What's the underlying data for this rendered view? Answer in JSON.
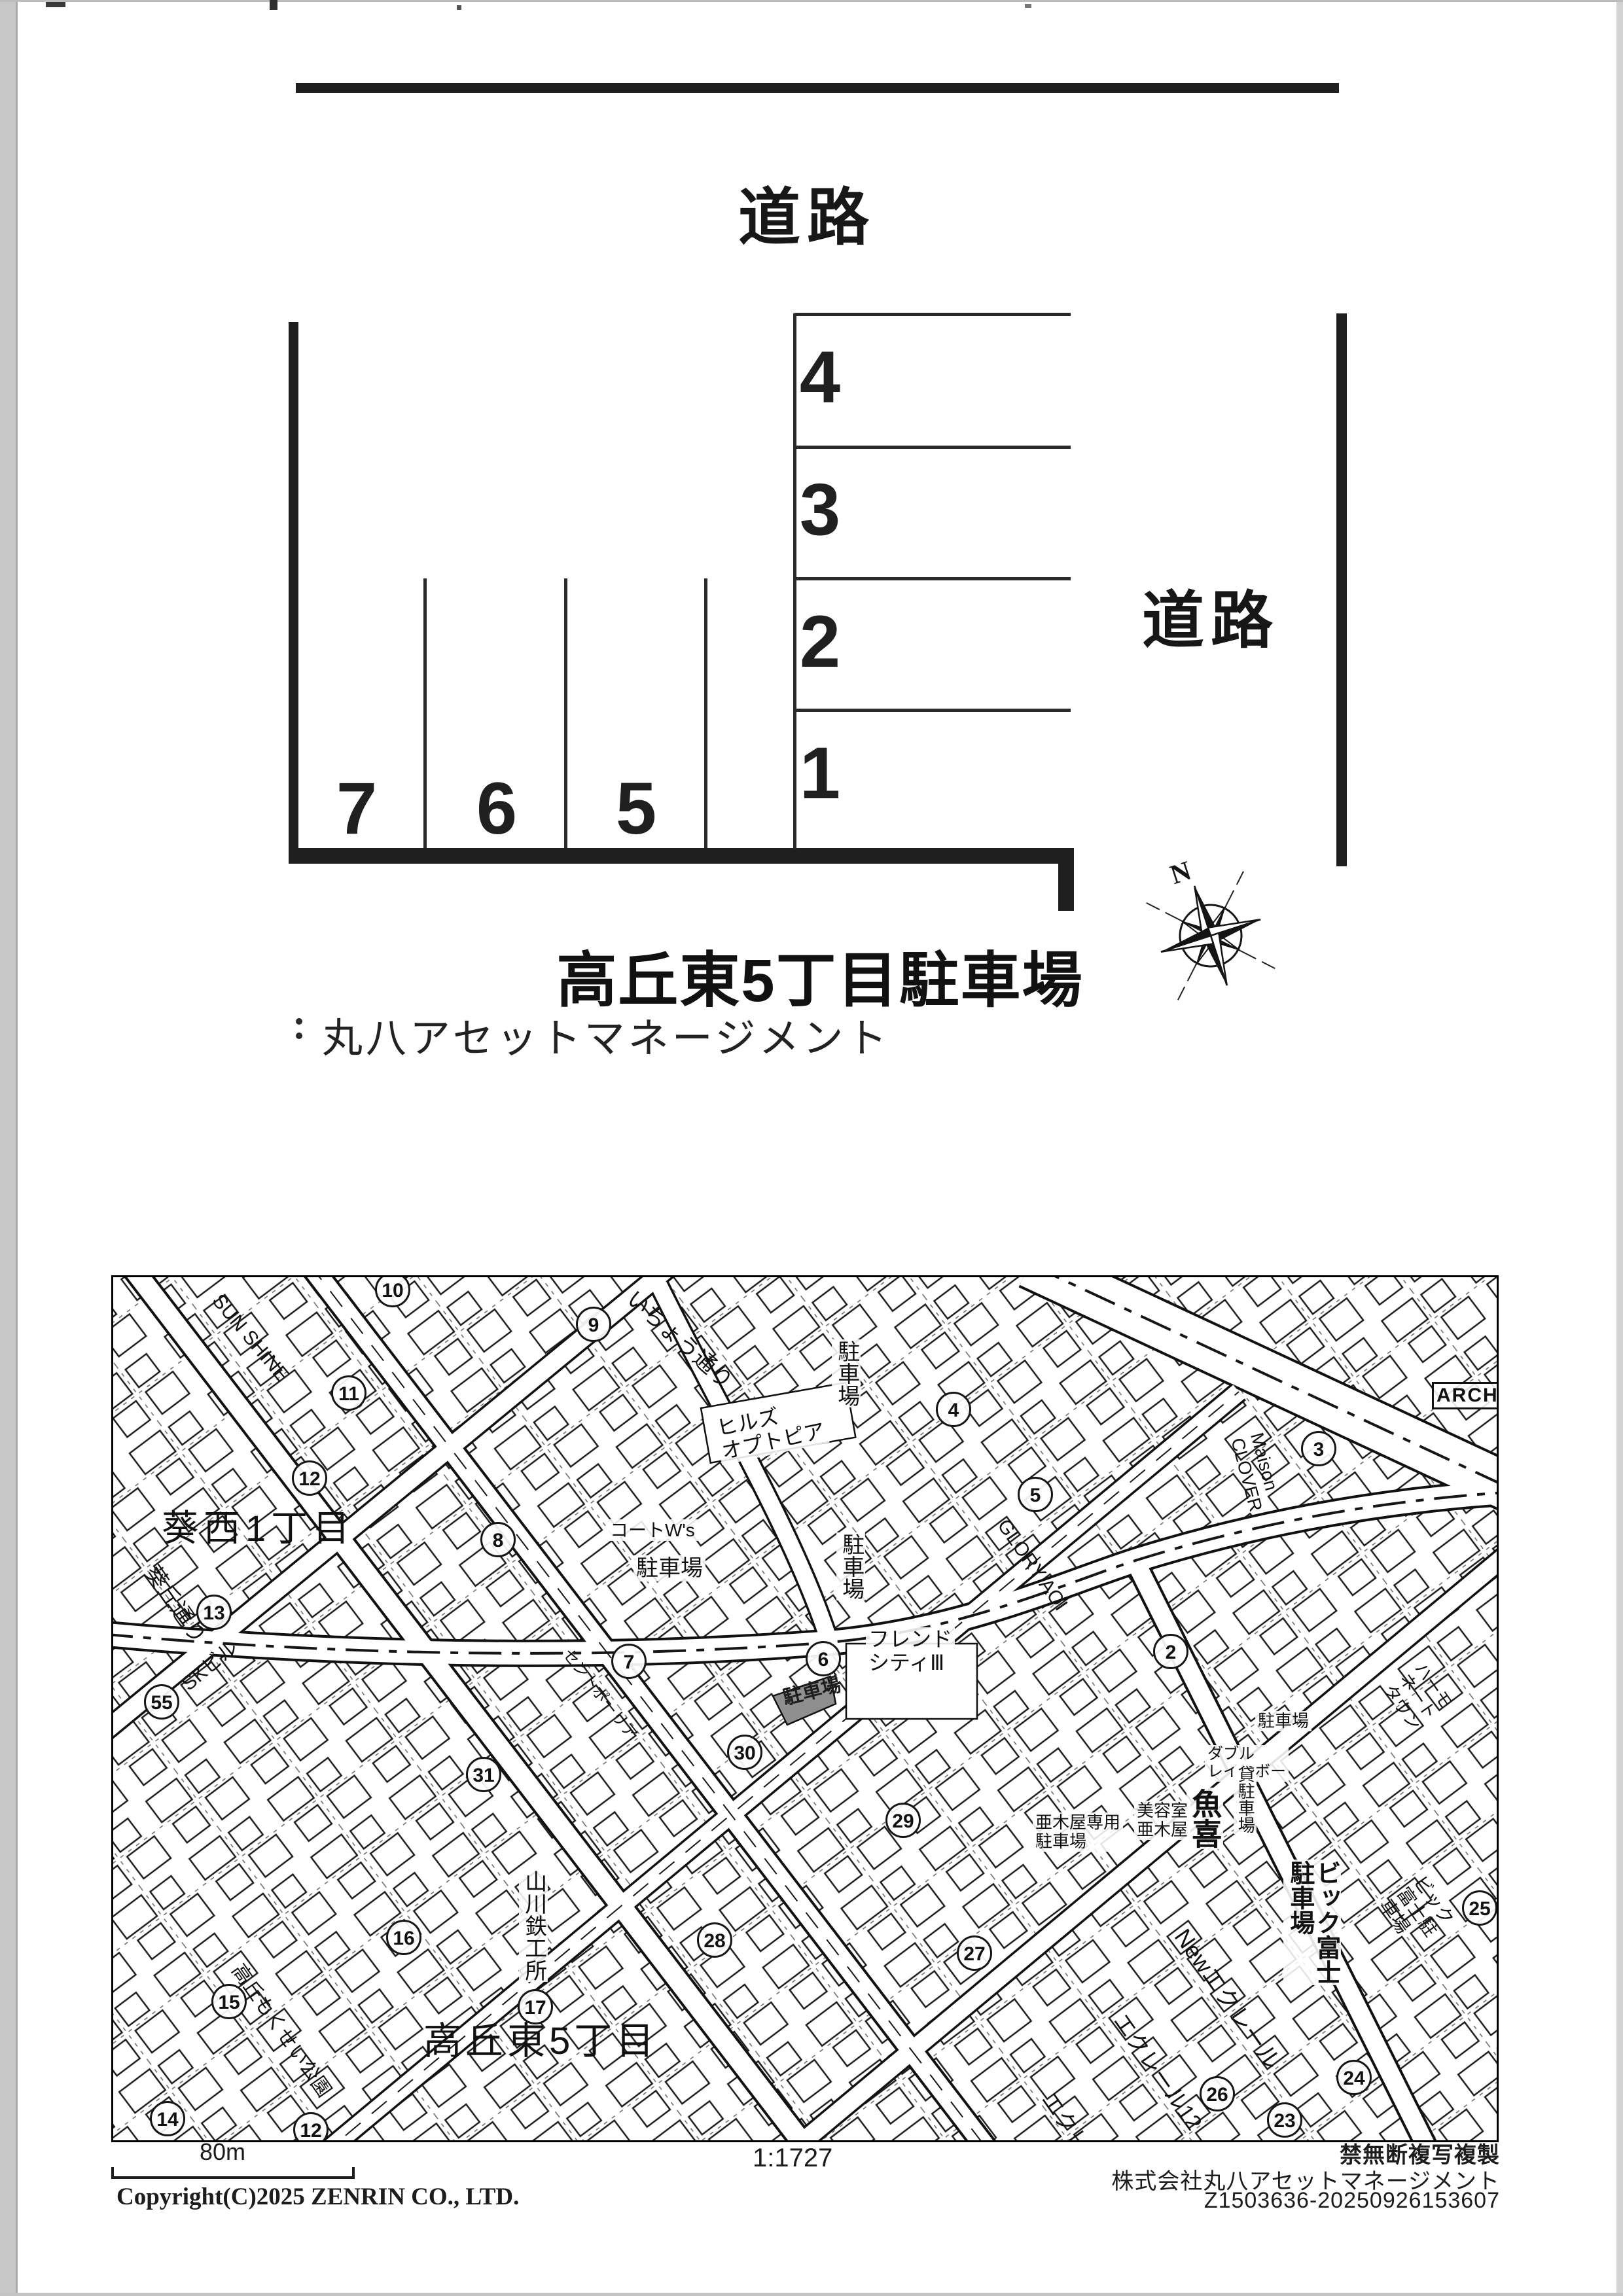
{
  "parking_diagram": {
    "road_top": "道路",
    "road_right": "道路",
    "stalls_right": [
      "4",
      "3",
      "2",
      "1"
    ],
    "stalls_bottom": [
      "7",
      "6",
      "5"
    ],
    "compass_north": "N",
    "title": "高丘東5丁目駐車場",
    "company": "丸八アセットマネージメント"
  },
  "icons": {
    "compass": "compass-rose",
    "company_mark": "two-dot-mark"
  },
  "map": {
    "labels": {
      "district_nw": "葵西1丁目",
      "district_sw": "高丘東5丁目",
      "street_aoioka": "葵丘通り",
      "street_icho": "いちょう通り",
      "sun_shine": "SUN SHINE",
      "parking_v1": "駐車場",
      "parking_v2": "駐車場",
      "parking_h1": "駐車場",
      "parking_h2": "駐車場",
      "hills_optopia": "ヒルズ\nオプトピア",
      "court_ws": "コートW's",
      "friend_city": "フレンド\nシティⅢ",
      "glory_aoi": "GLORY AOI",
      "maison_clover": "Maison\nCLOVER",
      "arch": "ARCH",
      "uoki": "魚喜",
      "biyoshitsu_akiya": "美容室\n亜木屋",
      "double_rainbow": "ダブル\nレインボー",
      "akiya_parking": "亜木屋専用\n駐車場",
      "kashi_parking": "貸駐車場",
      "bigfuji_v": "ビック富士\n駐車場",
      "bigfuji_diag": "ビック富士駐車場",
      "harmonate_town": "ハーモネートタウン",
      "new_eclair": "Newエクレール",
      "eclair12": "エクレール12",
      "eclair16": "エクレール16",
      "yamakawa": "山川鉄工所",
      "sk_bldg": "SKビル",
      "mokusei_park": "高丘もくせい公園",
      "saint_paulia": "セントポーリア",
      "subject_parking": "駐車場"
    },
    "circles": [
      "10",
      "11",
      "12",
      "13",
      "9",
      "4",
      "3",
      "5",
      "8",
      "7",
      "6",
      "2",
      "55",
      "31",
      "30",
      "29",
      "16",
      "15",
      "17",
      "28",
      "14",
      "12",
      "27",
      "26",
      "24",
      "23",
      "25"
    ]
  },
  "footer": {
    "scale_bar_label": "80m",
    "scale_ratio": "1:1727",
    "notice": "禁無断複写複製",
    "company": "株式会社丸八アセットマネージメント",
    "code": "Z1503636-20250926153607",
    "copyright": "Copyright(C)2025 ZENRIN CO., LTD."
  }
}
